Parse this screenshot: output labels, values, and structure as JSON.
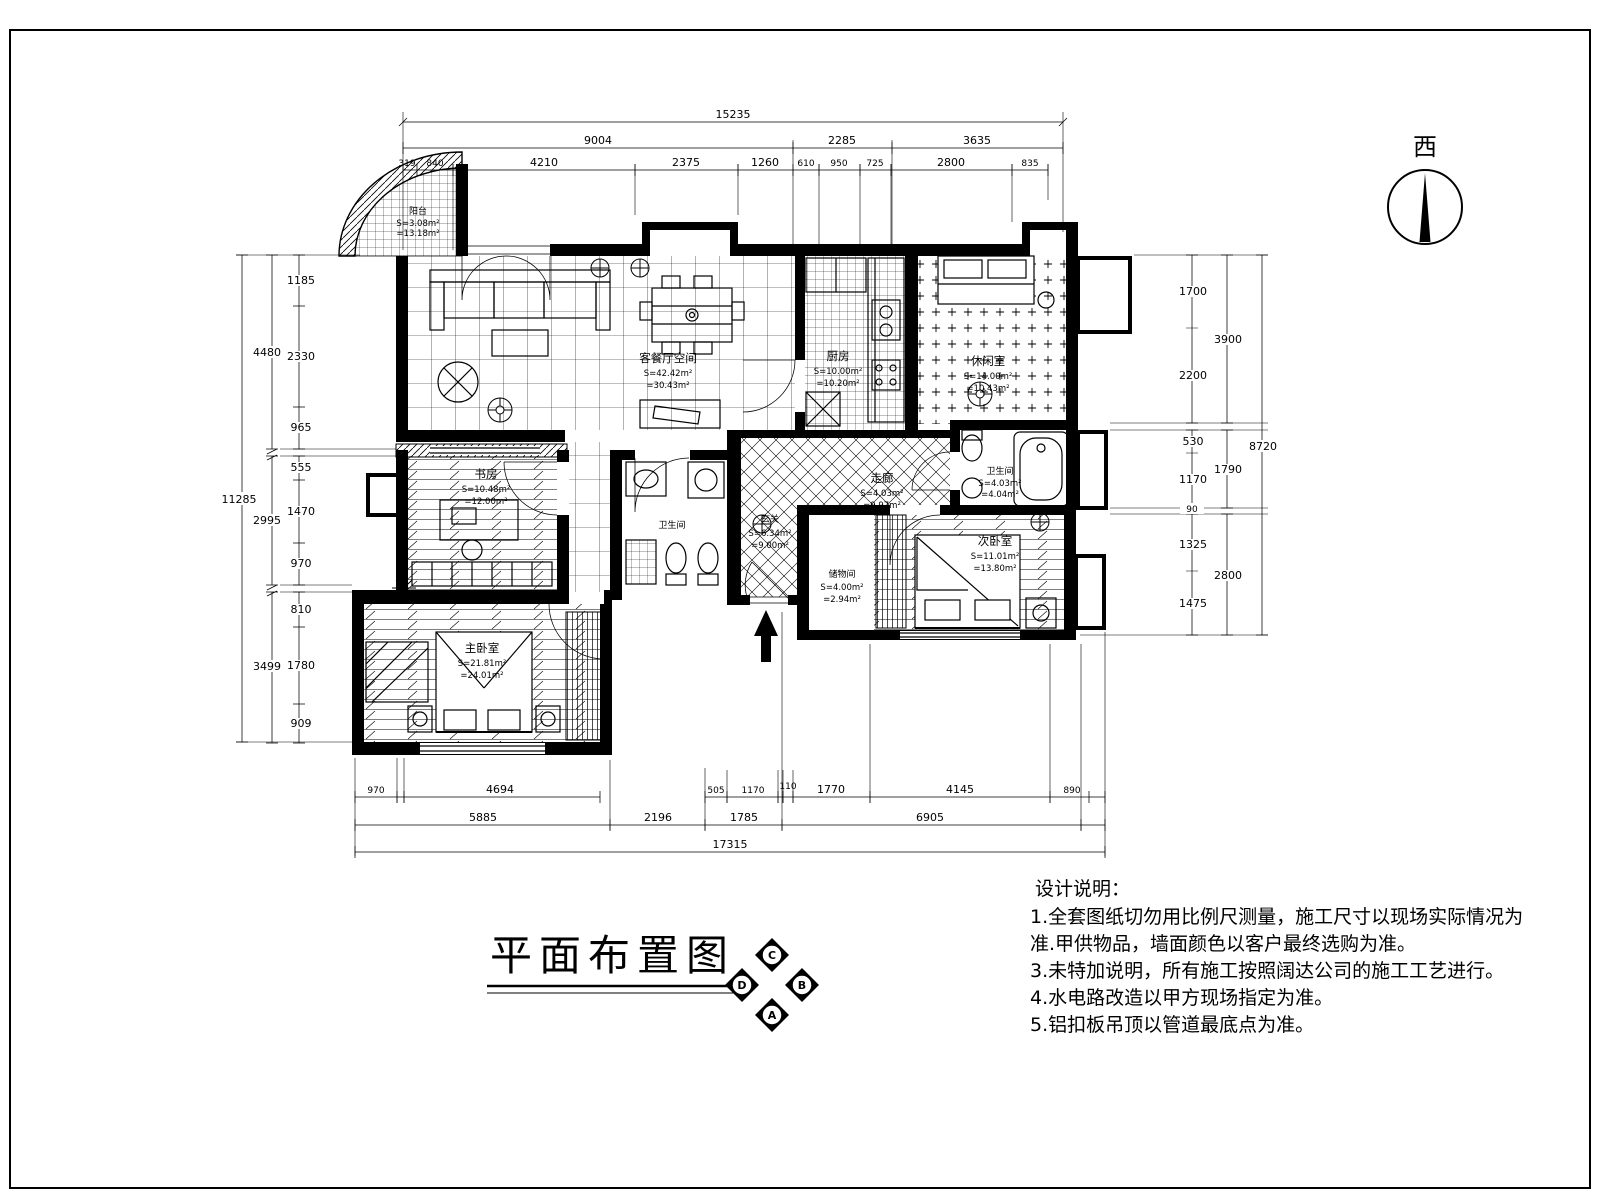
{
  "meta": {
    "title": "平面布置图",
    "compass": "西"
  },
  "badge": {
    "top": "C",
    "right": "B",
    "bottom": "A",
    "left": "D"
  },
  "notes": {
    "heading": "设计说明：",
    "lines": [
      "1.全套图纸切勿用比例尺测量，施工尺寸以现场实际情况为",
      "准.甲供物品，墙面颜色以客户最终选购为准。",
      "3.未特加说明，所有施工按照阔达公司的施工工艺进行。",
      "4.水电路改造以甲方现场指定为准。",
      "5.铝扣板吊顶以管道最底点为准。"
    ]
  },
  "dimensions": {
    "top": {
      "total": "15235",
      "row2": [
        "9004",
        "2285",
        "3635"
      ],
      "row3": [
        "319",
        "840",
        "4210",
        "2375",
        "1260",
        "610",
        "950",
        "725",
        "2800",
        "835"
      ]
    },
    "left": {
      "total": "11285",
      "mid": [
        "4480",
        "2995",
        "3499"
      ],
      "inner": [
        "1185",
        "2330",
        "965",
        "555",
        "1470",
        "970",
        "810",
        "1780",
        "909"
      ]
    },
    "right": {
      "total": "8720",
      "mid": [
        "3900",
        "1790",
        "2800"
      ],
      "inner": [
        "1700",
        "2200",
        "530",
        "1170",
        "90",
        "1325",
        "1475"
      ]
    },
    "bottom": {
      "total": "17315",
      "row2": [
        "5885",
        "2196",
        "1785",
        "6905"
      ],
      "row1": [
        "970",
        "4694",
        "505",
        "1170",
        "110",
        "1770",
        "4145",
        "890"
      ]
    }
  },
  "rooms": [
    {
      "name": "阳台",
      "area1": "S=3.08m²",
      "area2": "=13.18m²"
    },
    {
      "name": "客餐厅空间",
      "area1": "S=42.42m²",
      "area2": "=30.43m²"
    },
    {
      "name": "厨房",
      "area1": "S=10.00m²",
      "area2": "=10.20m²"
    },
    {
      "name": "休闲室",
      "area1": "S=14.00m²",
      "area2": "=10.43m²"
    },
    {
      "name": "书房",
      "area1": "S=10.48m²",
      "area2": "=12.00m²"
    },
    {
      "name": "走廊",
      "area1": "S=4.03m²",
      "area2": "=9.97m²"
    },
    {
      "name": "卫生间",
      "area1": "S=4.03m²",
      "area2": "=4.04m²"
    },
    {
      "name": "卫生间",
      "area1": "",
      "area2": ""
    },
    {
      "name": "玄关",
      "area1": "S=6.34m²",
      "area2": "=9.00m²"
    },
    {
      "name": "储物间",
      "area1": "S=4.00m²",
      "area2": "=2.94m²"
    },
    {
      "name": "次卧室",
      "area1": "S=11.01m²",
      "area2": "=13.80m²"
    },
    {
      "name": "主卧室",
      "area1": "S=21.81m²",
      "area2": "=24.01m²"
    }
  ]
}
